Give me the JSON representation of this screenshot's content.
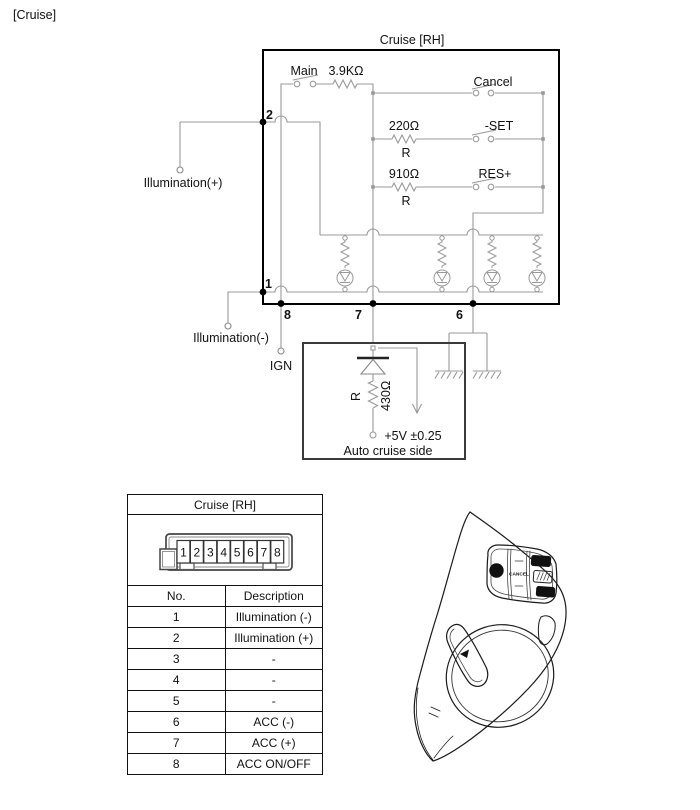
{
  "page": {
    "corner_label": "[Cruise]"
  },
  "schematic": {
    "box_title": "Cruise [RH]",
    "labels": {
      "main": "Main",
      "main_resistor": "3.9KΩ",
      "cancel": "Cancel",
      "set_resistor": "220Ω",
      "set": "-SET",
      "res_resistor": "910Ω",
      "res": "RES+",
      "r1": "R",
      "r2": "R",
      "illumination_plus": "Illumination(+)",
      "illumination_minus": "Illumination(-)",
      "ign": "IGN"
    },
    "pins": {
      "p1": "1",
      "p2": "2",
      "p6": "6",
      "p7": "7",
      "p8": "8"
    },
    "module": {
      "r": "R",
      "resistor": "430Ω",
      "voltage": "+5V ±0.25",
      "caption": "Auto cruise side"
    }
  },
  "connector": {
    "title": "Cruise [RH]",
    "pins": [
      "1",
      "2",
      "3",
      "4",
      "5",
      "6",
      "7",
      "8"
    ],
    "col_no": "No.",
    "col_desc": "Description",
    "rows": [
      [
        "1",
        "Illumination (-)"
      ],
      [
        "2",
        "Illumination (+)"
      ],
      [
        "3",
        "-"
      ],
      [
        "4",
        "-"
      ],
      [
        "5",
        "-"
      ],
      [
        "6",
        "ACC (-)"
      ],
      [
        "7",
        "ACC (+)"
      ],
      [
        "8",
        "ACC ON/OFF"
      ]
    ]
  },
  "wheel": {
    "on": "ON",
    "off": "OFF",
    "cancel": "CANCEL",
    "res": "RES+",
    "set": "SET-"
  },
  "colors": {
    "wire": "#999999",
    "box": "#000000",
    "module_box": "#3a3a3a"
  }
}
